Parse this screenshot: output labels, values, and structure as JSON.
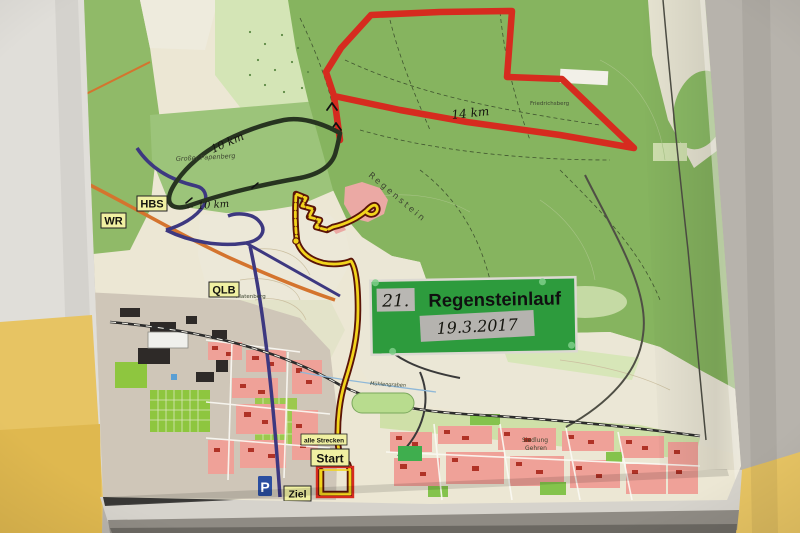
{
  "sign": {
    "number": "21.",
    "title": "Regensteinlauf",
    "date": "19.3.2017"
  },
  "distances": {
    "red_route": "14 km",
    "black_route_upper": "10 km",
    "black_route_lower": "10 km",
    "direction_arrow": "←"
  },
  "station_labels": {
    "hbs": "HBS",
    "wr": "WR",
    "qlb": "QLB"
  },
  "course_labels": {
    "all_courses": "alle Strecken",
    "start": "Start",
    "finish": "Ziel",
    "parking": "P"
  },
  "map_texts": {
    "regenstein": "Regenstein",
    "grosser_papenberg": "Großer Papenberg",
    "platenberg": "Platenberg",
    "friedrichsberg": "Friedrichsberg",
    "siedlung_line1": "Siedlung",
    "siedlung_line2": "Gehren",
    "muehlengraben": "Mühlengraben"
  },
  "colors": {
    "route_red": "#d62b1f",
    "route_black": "#273420",
    "route_yellow": "#f2d41c",
    "route_outline": "#5a1408",
    "sign_green": "#2d9b3d",
    "label_yellow": "#f0f0a2",
    "parking_blue": "#2b4ea0",
    "wall_yellow": "#e7c463",
    "forest_green": "#86b45f"
  }
}
